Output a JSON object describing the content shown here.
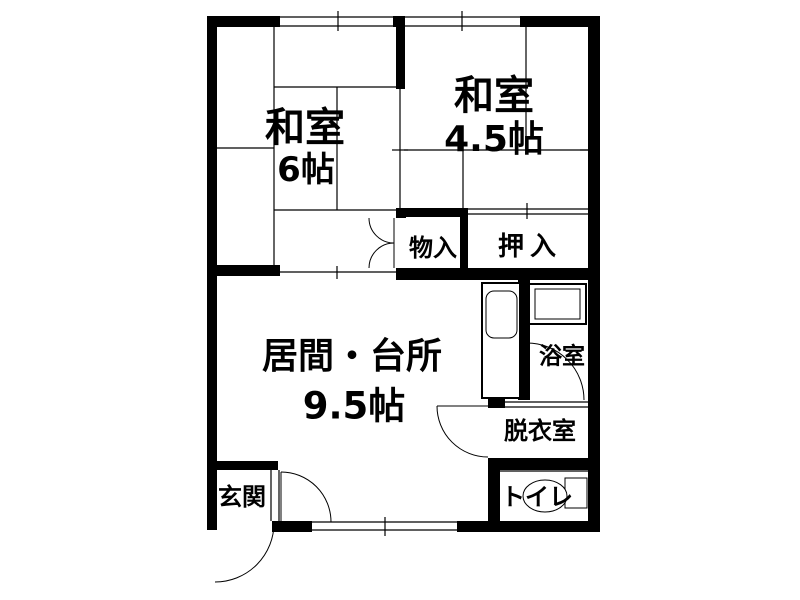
{
  "floor_plan": {
    "background_color": "#ffffff",
    "wall_color": "#000000",
    "line_color": "#000000",
    "rooms": {
      "washitsu6": {
        "name": "和室",
        "size": "6帖"
      },
      "washitsu45": {
        "name": "和室",
        "size": "4.5帖"
      },
      "living_kitchen": {
        "name": "居間・台所",
        "size": "9.5帖"
      },
      "storage": {
        "name": "物入"
      },
      "closet": {
        "name": "押入"
      },
      "bathroom": {
        "name": "浴室"
      },
      "dressing_room": {
        "name": "脱衣室"
      },
      "toilet": {
        "name": "トイレ"
      },
      "entrance": {
        "name": "玄関"
      }
    },
    "fixtures": [
      "kitchen-sink",
      "bathtub",
      "toilet-bowl"
    ]
  }
}
